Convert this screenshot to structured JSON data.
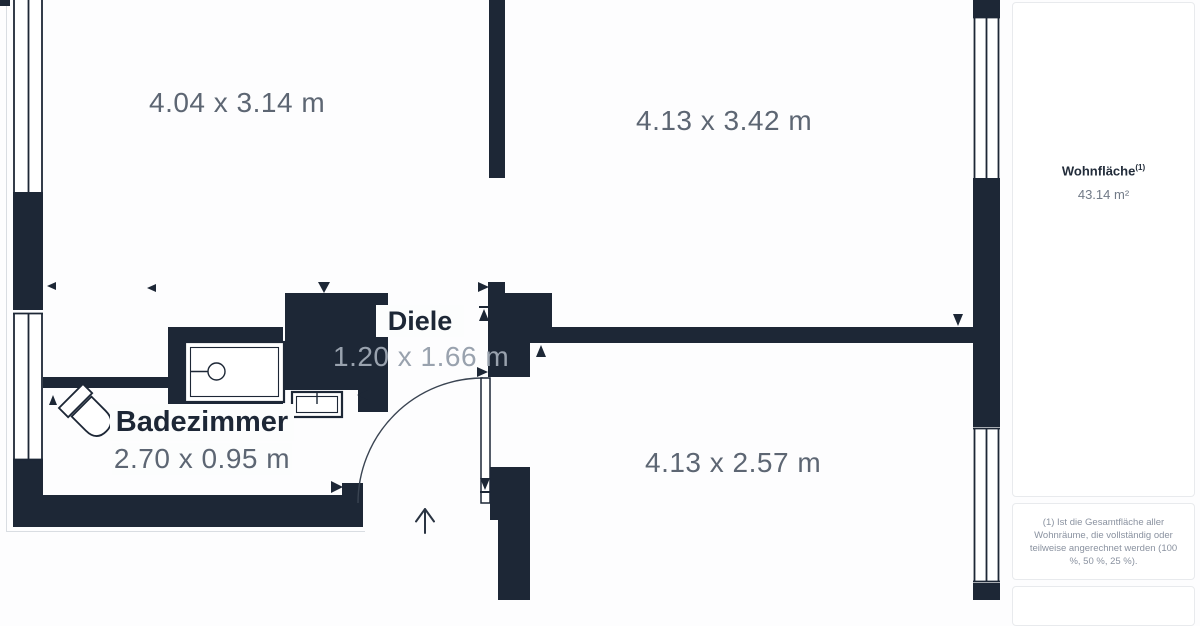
{
  "plan": {
    "room_top_left": {
      "dims": "4.04 x 3.14 m"
    },
    "room_top_right": {
      "dims": "4.13 x 3.42 m"
    },
    "room_bottom_right": {
      "dims": "4.13 x 2.57 m"
    },
    "hallway": {
      "name": "Diele",
      "dims": "1.20 x 1.66 m"
    },
    "bathroom": {
      "name": "Badezimmer",
      "dims": "2.70 x 0.95 m"
    }
  },
  "sidebar": {
    "area_label": "Wohnfläche",
    "area_footnote_marker": "(1)",
    "area_value": "43.14 m²",
    "footnote": "(1) Ist die Gesamtfläche aller Wohnräume, die vollständig oder teilweise angerechnet werden (100 %, 50 %, 25 %)."
  },
  "colors": {
    "wall": "#1d2736",
    "dim_text": "#5d6673",
    "dim_text_light": "#99a2ae",
    "outline_light": "#d9dde2"
  }
}
